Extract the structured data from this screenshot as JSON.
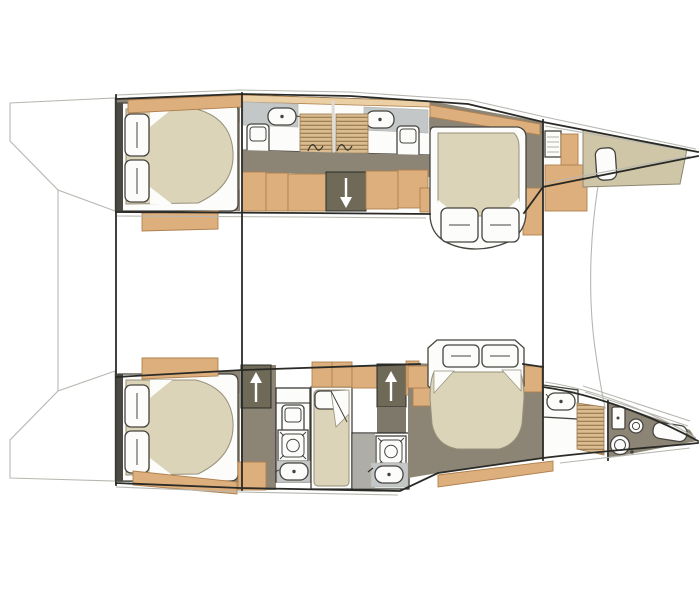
{
  "title": "catamaran-interior-floor-plan",
  "palette": {
    "paper": "#ffffff",
    "line_dark": "#2a2a26",
    "line_mid": "#8d8570",
    "line_light": "#b7b7b1",
    "wood": "#ddaf7d",
    "wood_light": "#ebd0a6",
    "wood_dark": "#b08150",
    "louvre": "#d9bc8f",
    "louvre_stripe": "#9a774e",
    "floor": "#8c8576",
    "floor_dark": "#6f6958",
    "floor_light": "#9c9585",
    "floor_gray": "#7e786b",
    "mattress": "#dbd4b8",
    "mattress_line": "#97907a",
    "khaki": "#cfc6a8",
    "counter": "#c4c7c7",
    "wet": "#aeada6",
    "white_fix": "#fcfcfb",
    "fixture": "#45443f"
  },
  "icons": {
    "sink-icon": "rounded rectangle with center drain dot",
    "shower-icon": "square pan with inner tray and round drain",
    "toilet-icon": "tall rounded rectangle with seat line",
    "wc-round-icon": "round bowl circle with flush dot",
    "stairs-up-icon": "dark tread block with white up arrow",
    "stairs-down-icon": "dark tread block with white down arrow",
    "louvre-door-icon": "slatted wood door stripes",
    "porthole-icon": "double circle",
    "hatch-icon": "rounded rectangle deck hatch",
    "pillow-icon": "soft white rectangle with crease",
    "wardrobe-icon": "tan cabinetry block",
    "side-deck-icon": "tan walkway strip",
    "bow-locker-icon": "khaki foredeck wedge"
  },
  "plan": {
    "vessel_outline": "twin-hull catamaran, bows pointing right, transom platforms left, bridge-deck saloon between hulls",
    "hulls": [
      {
        "id": "port-hull-top",
        "rooms": [
          {
            "label": "aft double cabin with island berth and two pillows"
          },
          {
            "label": "aft bathroom with sink, toilet and louvre shower door"
          },
          {
            "label": "companionway stairs down from saloon"
          },
          {
            "label": "forward bathroom with sink, toilet and louvre shower door"
          },
          {
            "label": "forward double cabin with island berth"
          },
          {
            "label": "bow storage locker with deck hatch"
          }
        ]
      },
      {
        "id": "starboard-hull-bottom",
        "rooms": [
          {
            "label": "aft double cabin with island berth and two pillows"
          },
          {
            "label": "companionway stairs up to saloon (aft)"
          },
          {
            "label": "aft shower room with toilet, shower pan and sink"
          },
          {
            "label": "single berth compartment"
          },
          {
            "label": "companionway stairs up to saloon (forward)"
          },
          {
            "label": "midship shower room with shower pan and sink"
          },
          {
            "label": "forward double cabin with island berth"
          },
          {
            "label": "forward head in bow with sink, WC, porthole and hull window"
          }
        ]
      }
    ]
  }
}
